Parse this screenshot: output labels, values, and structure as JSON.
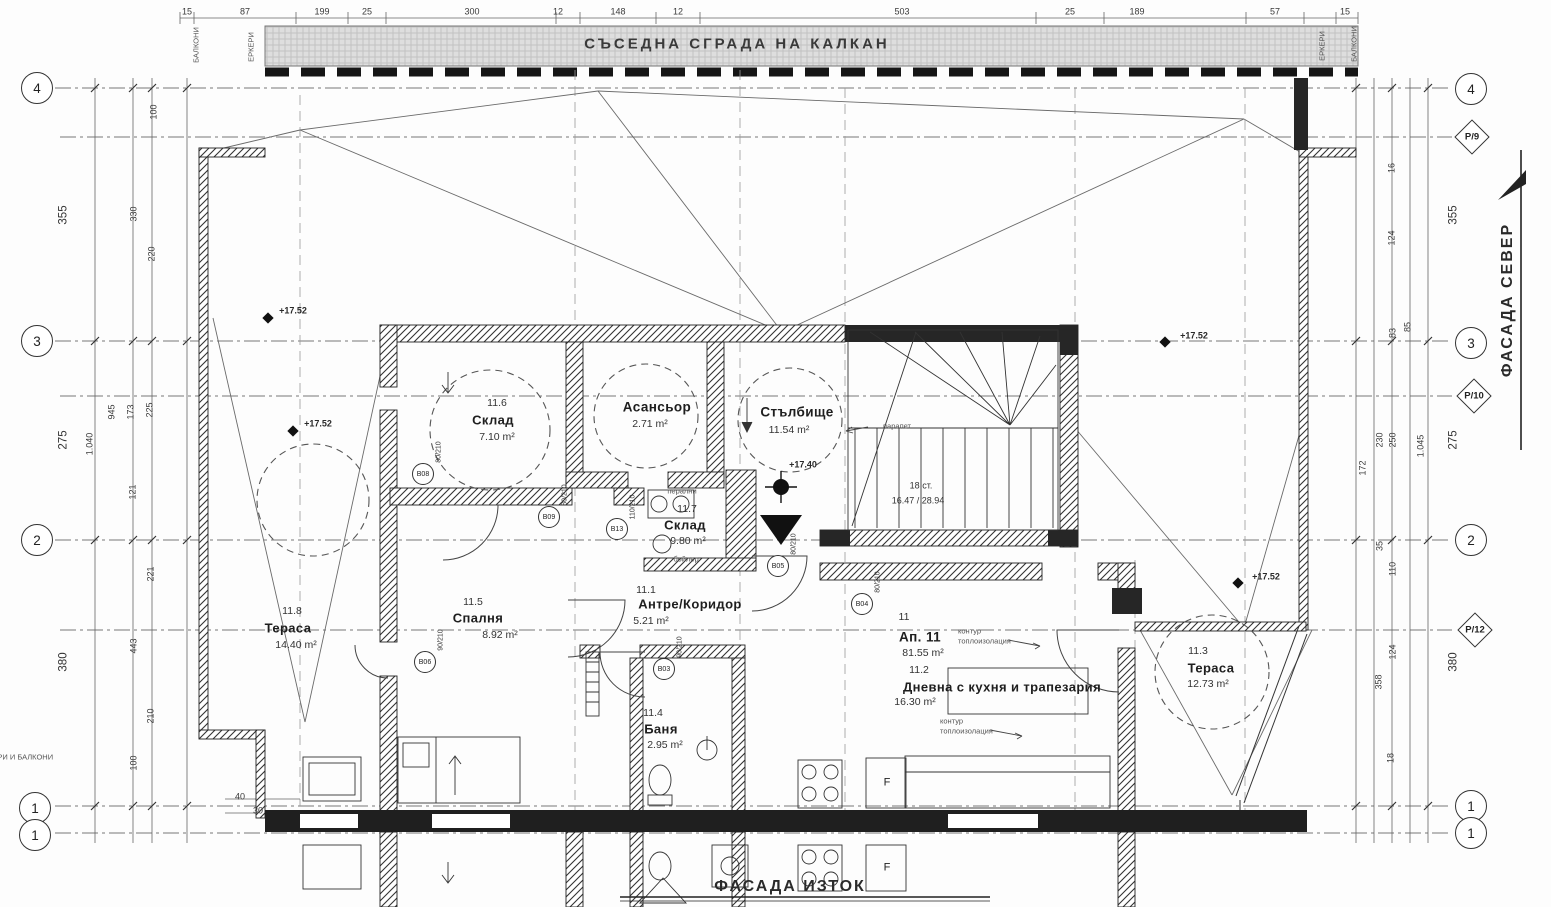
{
  "drawing": {
    "banner_title": "СЪСЕДНА СГРАДА НА КАЛКАН",
    "facade_north": "ФАСАДА СЕВЕР",
    "facade_east": "ФАСАДА ИЗТОК"
  },
  "grid_axes": {
    "left": [
      "4",
      "3",
      "2",
      "1",
      "1"
    ],
    "right_circles": [
      "4",
      "3",
      "2",
      "1",
      "1"
    ],
    "right_diamonds": [
      "P/9",
      "P/10",
      "P/12"
    ]
  },
  "rooms": {
    "elevator": {
      "name": "Асансьор",
      "area": "2.71 m²"
    },
    "stairwell": {
      "name": "Стълбище",
      "area": "11.54 m²"
    },
    "storage_a": {
      "num": "11.6",
      "name": "Склад",
      "area": "7.10 m²"
    },
    "storage_b": {
      "num": "11.7",
      "name": "Склад",
      "area": "9.80 m²",
      "note_top": "перални",
      "note_bottom": "бойлер"
    },
    "hall": {
      "num": "11.1",
      "name": "Антре/Коридор",
      "area": "5.21 m²"
    },
    "bedroom": {
      "num": "11.5",
      "name": "Спалня",
      "area": "8.92 m²"
    },
    "bath": {
      "num": "11.4",
      "name": "Баня",
      "area": "2.95 m²"
    },
    "terrace_west": {
      "num": "11.8",
      "name": "Тераса",
      "area": "14.40 m²"
    },
    "terrace_east": {
      "num": "11.3",
      "name": "Тераса",
      "area": "12.73 m²"
    },
    "living": {
      "num": "11.2",
      "name": "Дневна с кухня и трапезария",
      "area": "16.30 m²"
    },
    "apartment": {
      "sub": "11",
      "label": "Ап. 11",
      "area": "81.55 m²"
    }
  },
  "stairs": {
    "steps": "18 ст.",
    "riser_tread": "16.47 / 28.94",
    "rail_note": "парапет"
  },
  "levels": {
    "l1": "+17.52",
    "l2": "+17.52",
    "l3": "+17.52",
    "l4": "+17.52",
    "l5": "+17.40"
  },
  "annotations": {
    "insulation_1a": "контур",
    "insulation_1b": "топлоизолация",
    "insulation_2a": "контур",
    "insulation_2b": "топлоизолация",
    "balconies_left": "БАЛКОНИ",
    "bays_left": "ЕРКЕРИ",
    "balconies_right": "БАЛКОНИ",
    "bays_right": "ЕРКЕРИ",
    "bays_balconies": "ЕРКЕРИ И БАЛКОНИ",
    "fridge": "F"
  },
  "doors": [
    {
      "tag": "В08",
      "size": "80/210",
      "x": 423,
      "y": 474
    },
    {
      "tag": "В09",
      "size": "80/210",
      "x": 549,
      "y": 517
    },
    {
      "tag": "В13",
      "size": "110/210",
      "x": 617,
      "y": 529
    },
    {
      "tag": "В05",
      "size": "80/210",
      "x": 778,
      "y": 566
    },
    {
      "tag": "В06",
      "size": "90/210",
      "x": 425,
      "y": 662
    },
    {
      "tag": "В03",
      "size": "90/210",
      "x": 664,
      "y": 669
    },
    {
      "tag": "В04",
      "size": "80/210",
      "x": 862,
      "y": 604
    }
  ],
  "dims": {
    "top": [
      {
        "t": "15",
        "x": 187,
        "y": 12
      },
      {
        "t": "87",
        "x": 245,
        "y": 12
      },
      {
        "t": "199",
        "x": 322,
        "y": 12
      },
      {
        "t": "25",
        "x": 367,
        "y": 12
      },
      {
        "t": "300",
        "x": 472,
        "y": 12
      },
      {
        "t": "12",
        "x": 558,
        "y": 12
      },
      {
        "t": "148",
        "x": 618,
        "y": 12
      },
      {
        "t": "12",
        "x": 678,
        "y": 12
      },
      {
        "t": "503",
        "x": 902,
        "y": 12
      },
      {
        "t": "25",
        "x": 1070,
        "y": 12
      },
      {
        "t": "189",
        "x": 1137,
        "y": 12
      },
      {
        "t": "57",
        "x": 1275,
        "y": 12
      },
      {
        "t": "15",
        "x": 1345,
        "y": 12
      }
    ],
    "left": [
      {
        "t": "355",
        "x": 64,
        "y": 215,
        "r": 1,
        "s": 1
      },
      {
        "t": "275",
        "x": 64,
        "y": 440,
        "r": 1,
        "s": 1
      },
      {
        "t": "380",
        "x": 64,
        "y": 662,
        "r": 1,
        "s": 1
      },
      {
        "t": "100",
        "x": 154,
        "y": 112,
        "r": 1
      },
      {
        "t": "330",
        "x": 134,
        "y": 214,
        "r": 1
      },
      {
        "t": "220",
        "x": 152,
        "y": 254,
        "r": 1
      },
      {
        "t": "945",
        "x": 112,
        "y": 412,
        "r": 1
      },
      {
        "t": "173",
        "x": 131,
        "y": 412,
        "r": 1
      },
      {
        "t": "225",
        "x": 150,
        "y": 410,
        "r": 1
      },
      {
        "t": "1.040",
        "x": 90,
        "y": 444,
        "r": 1
      },
      {
        "t": "121",
        "x": 133,
        "y": 492,
        "r": 1
      },
      {
        "t": "221",
        "x": 151,
        "y": 574,
        "r": 1
      },
      {
        "t": "443",
        "x": 134,
        "y": 646,
        "r": 1
      },
      {
        "t": "210",
        "x": 151,
        "y": 716,
        "r": 1
      },
      {
        "t": "100",
        "x": 134,
        "y": 763,
        "r": 1
      }
    ],
    "right": [
      {
        "t": "355",
        "x": 1454,
        "y": 215,
        "r": 1,
        "s": 1
      },
      {
        "t": "275",
        "x": 1454,
        "y": 440,
        "r": 1,
        "s": 1
      },
      {
        "t": "380",
        "x": 1454,
        "y": 662,
        "r": 1,
        "s": 1
      },
      {
        "t": "16",
        "x": 1392,
        "y": 168,
        "r": 1
      },
      {
        "t": "124",
        "x": 1392,
        "y": 238,
        "r": 1
      },
      {
        "t": "85",
        "x": 1408,
        "y": 327,
        "r": 1
      },
      {
        "t": "83",
        "x": 1393,
        "y": 333,
        "r": 1
      },
      {
        "t": "230",
        "x": 1380,
        "y": 440,
        "r": 1
      },
      {
        "t": "250",
        "x": 1393,
        "y": 440,
        "r": 1
      },
      {
        "t": "1.045",
        "x": 1421,
        "y": 446,
        "r": 1
      },
      {
        "t": "172",
        "x": 1363,
        "y": 468,
        "r": 1
      },
      {
        "t": "35",
        "x": 1380,
        "y": 546,
        "r": 1
      },
      {
        "t": "110",
        "x": 1393,
        "y": 569,
        "r": 1
      },
      {
        "t": "124",
        "x": 1393,
        "y": 652,
        "r": 1
      },
      {
        "t": "358",
        "x": 1379,
        "y": 682,
        "r": 1
      },
      {
        "t": "18",
        "x": 1391,
        "y": 758,
        "r": 1
      }
    ],
    "misc": [
      {
        "t": "40",
        "x": 240,
        "y": 797
      },
      {
        "t": "30",
        "x": 258,
        "y": 811
      }
    ]
  }
}
